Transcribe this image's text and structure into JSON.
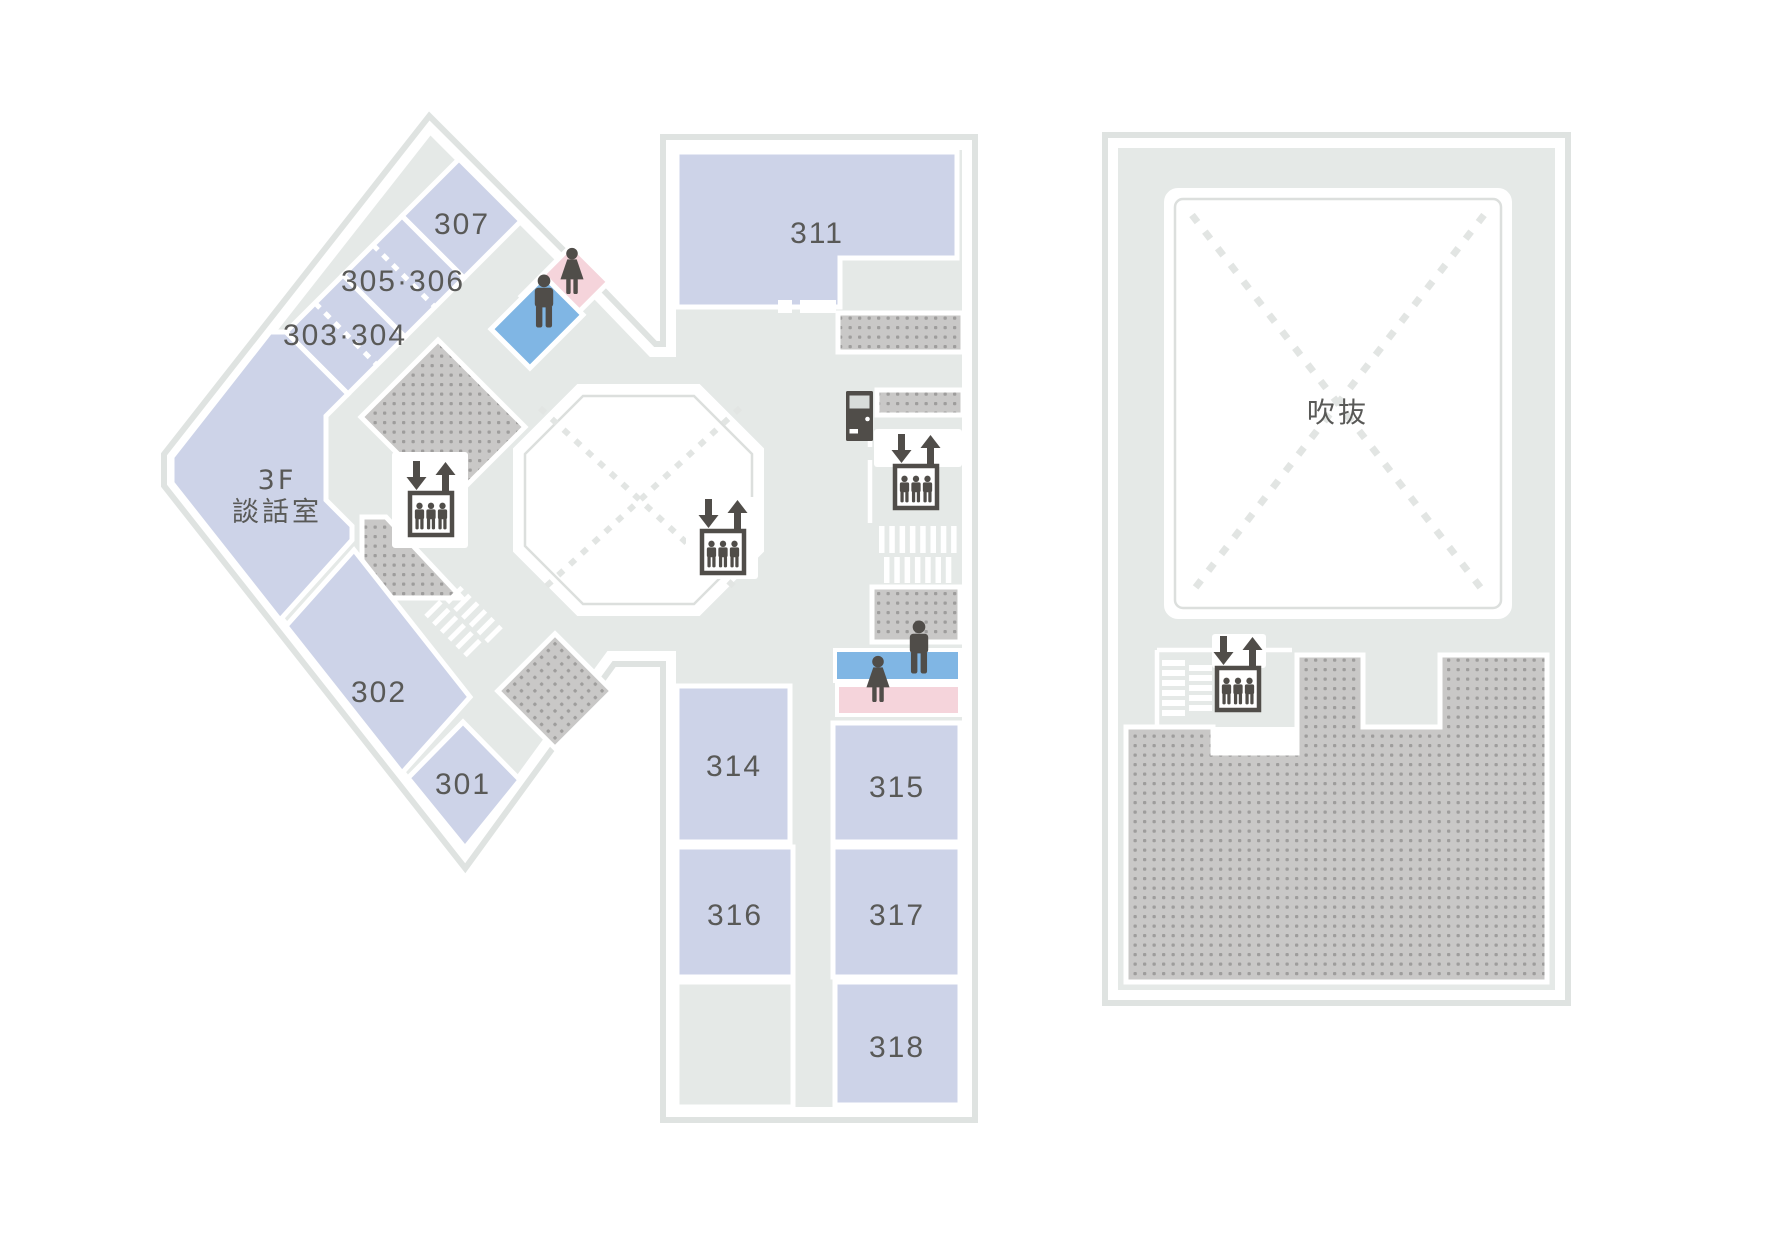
{
  "floor_plan": {
    "building_left": {
      "rooms": {
        "r301": "301",
        "r302": "302",
        "r303_304": "303·304",
        "r305_306": "305·306",
        "r307": "307",
        "r311": "311",
        "r314": "314",
        "r315": "315",
        "r316": "316",
        "r317": "317",
        "r318": "318"
      },
      "lounge": {
        "line1": "3F",
        "line2": "談話室"
      }
    },
    "building_right": {
      "atrium_label": "吹抜"
    },
    "icons": {
      "elevator": "elevator-icon",
      "stairs": "stairs-icon",
      "mens_restroom": "mens-restroom-icon",
      "womens_restroom": "womens-restroom-icon",
      "vending_machine": "vending-machine-icon",
      "void_cross": "void-diagonal-cross"
    },
    "colors": {
      "floor": "#e5e9e7",
      "wall_band": "#dfe3e1",
      "room_fill": "#cdd3e8",
      "mens_blue": "#80b6e4",
      "womens_pink": "#f5d4db",
      "icon_dark": "#504d49",
      "hatch_bg": "#c9c8c7",
      "hatch_dot": "#9e9d9c",
      "label_text": "#595957"
    }
  }
}
